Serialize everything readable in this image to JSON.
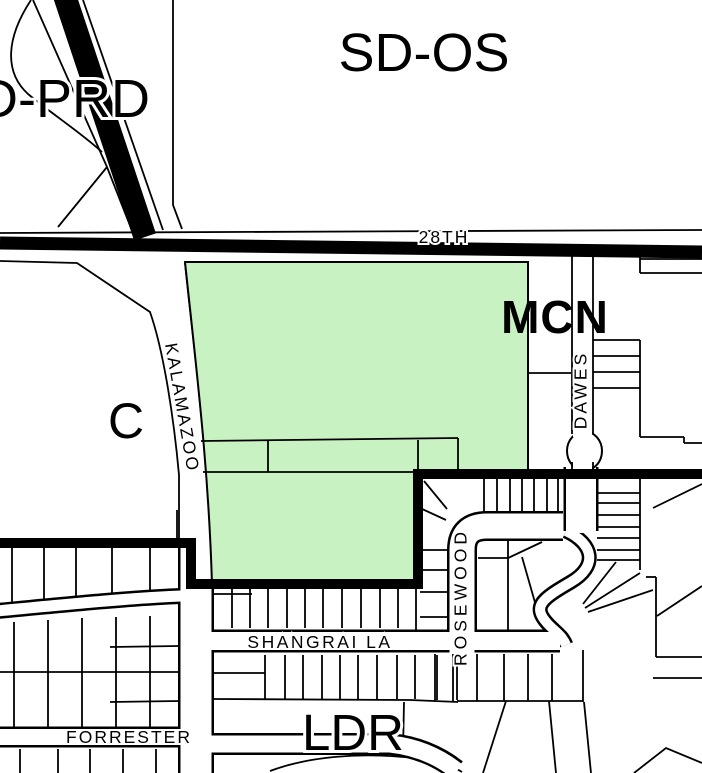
{
  "map": {
    "background": "#ffffff",
    "line_color": "#000000",
    "highlight_fill": "#c9f2c2",
    "mcn_color": "#9e9e9e",
    "zone_labels": {
      "sd_os": "SD-OS",
      "d_prd": "D-PRD",
      "c": "C",
      "mcn": "MCN",
      "ldr": "LDR"
    },
    "street_labels": {
      "s28th": "28TH",
      "kalamazoo": "KALAMAZOO",
      "dawes": "DAWES",
      "rosewood": "ROSEWOOD",
      "shangrai_la": "SHANGRAI LA",
      "forrester": "FORRESTER"
    }
  }
}
